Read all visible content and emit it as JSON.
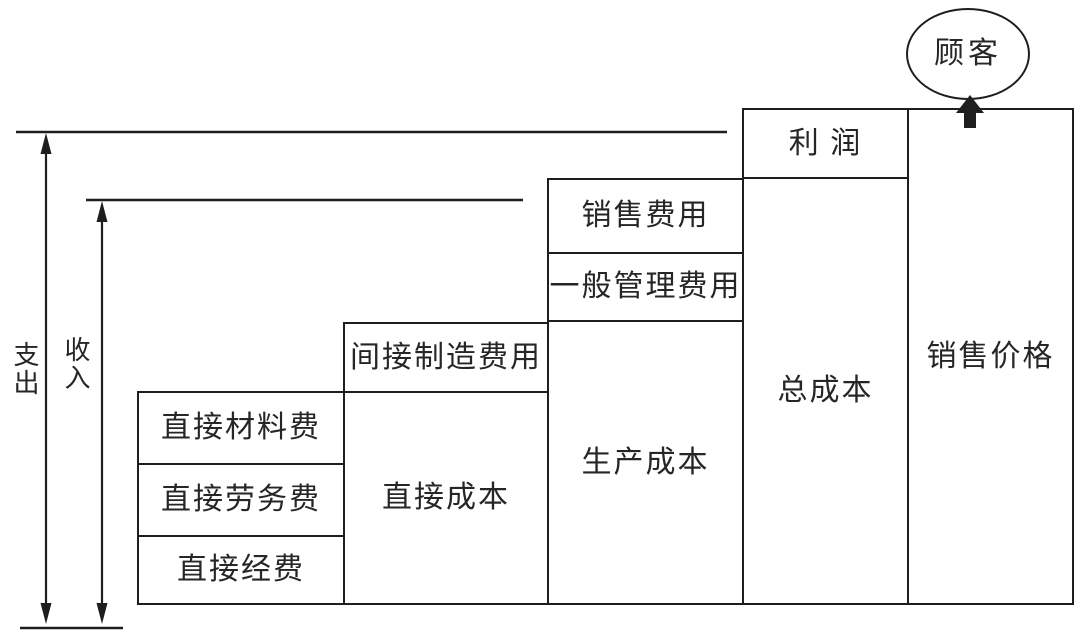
{
  "colors": {
    "line": "#1e1e1e",
    "text": "#262626",
    "background": "#ffffff"
  },
  "labels": {
    "expenditure": "支出",
    "income": "收入",
    "customer": "顾客"
  },
  "boxes": {
    "direct_material": "直接材料费",
    "direct_labor": "直接劳务费",
    "direct_expense": "直接经费",
    "indirect_manufacturing": "间接制造费用",
    "direct_cost": "直接成本",
    "selling_expense": "销售费用",
    "general_admin_expense": "一般管理费用",
    "production_cost": "生产成本",
    "profit": "利 润",
    "total_cost": "总成本",
    "selling_price": "销售价格"
  }
}
